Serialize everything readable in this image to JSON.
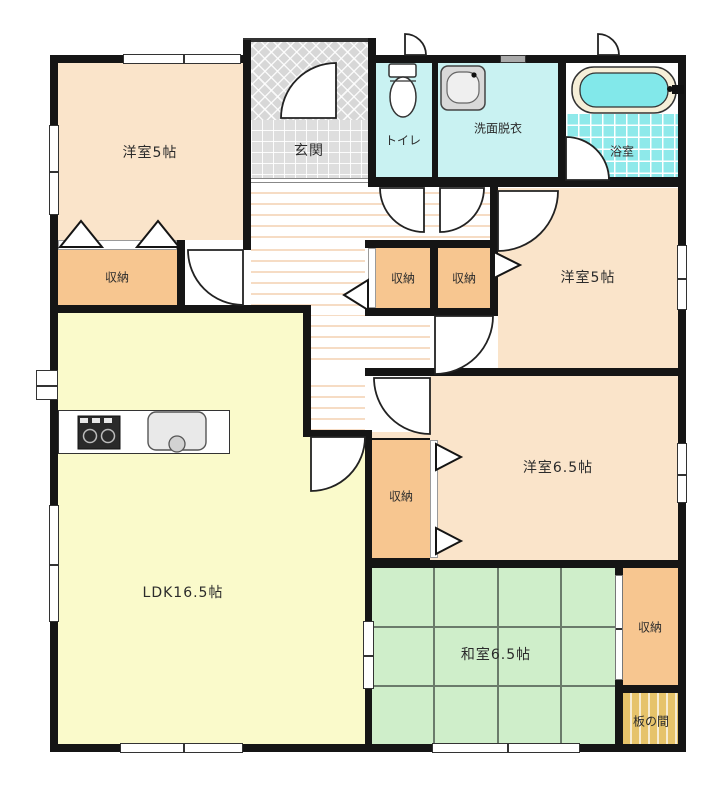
{
  "plan": {
    "type": "floor-plan",
    "rooms": {
      "room_a": {
        "label": "洋室5帖"
      },
      "genkan": {
        "label": "玄関"
      },
      "toilet": {
        "label": "トイレ"
      },
      "washroom": {
        "label": "洗面脱衣"
      },
      "bathroom": {
        "label": "浴室"
      },
      "closet_a": {
        "label": "収納"
      },
      "closet_h1": {
        "label": "収納"
      },
      "closet_h2": {
        "label": "収納"
      },
      "room_b": {
        "label": "洋室5帖"
      },
      "room_c": {
        "label": "洋室6.5帖"
      },
      "closet_c": {
        "label": "収納"
      },
      "ldk": {
        "label": "LDK16.5帖"
      },
      "washitsu": {
        "label": "和室6.5帖"
      },
      "closet_w": {
        "label": "収納"
      },
      "itanoma": {
        "label": "板の間"
      }
    },
    "colors": {
      "wall": "#151515",
      "peach": "#fae4ca",
      "orange": "#f7c690",
      "yellow": "#fafacb",
      "green": "#cfeeca",
      "cyan": "#c9f2f2",
      "bathtile": "#8ee9ea",
      "wood": "#e6c36a",
      "stripe": "#f6dcc4"
    }
  }
}
